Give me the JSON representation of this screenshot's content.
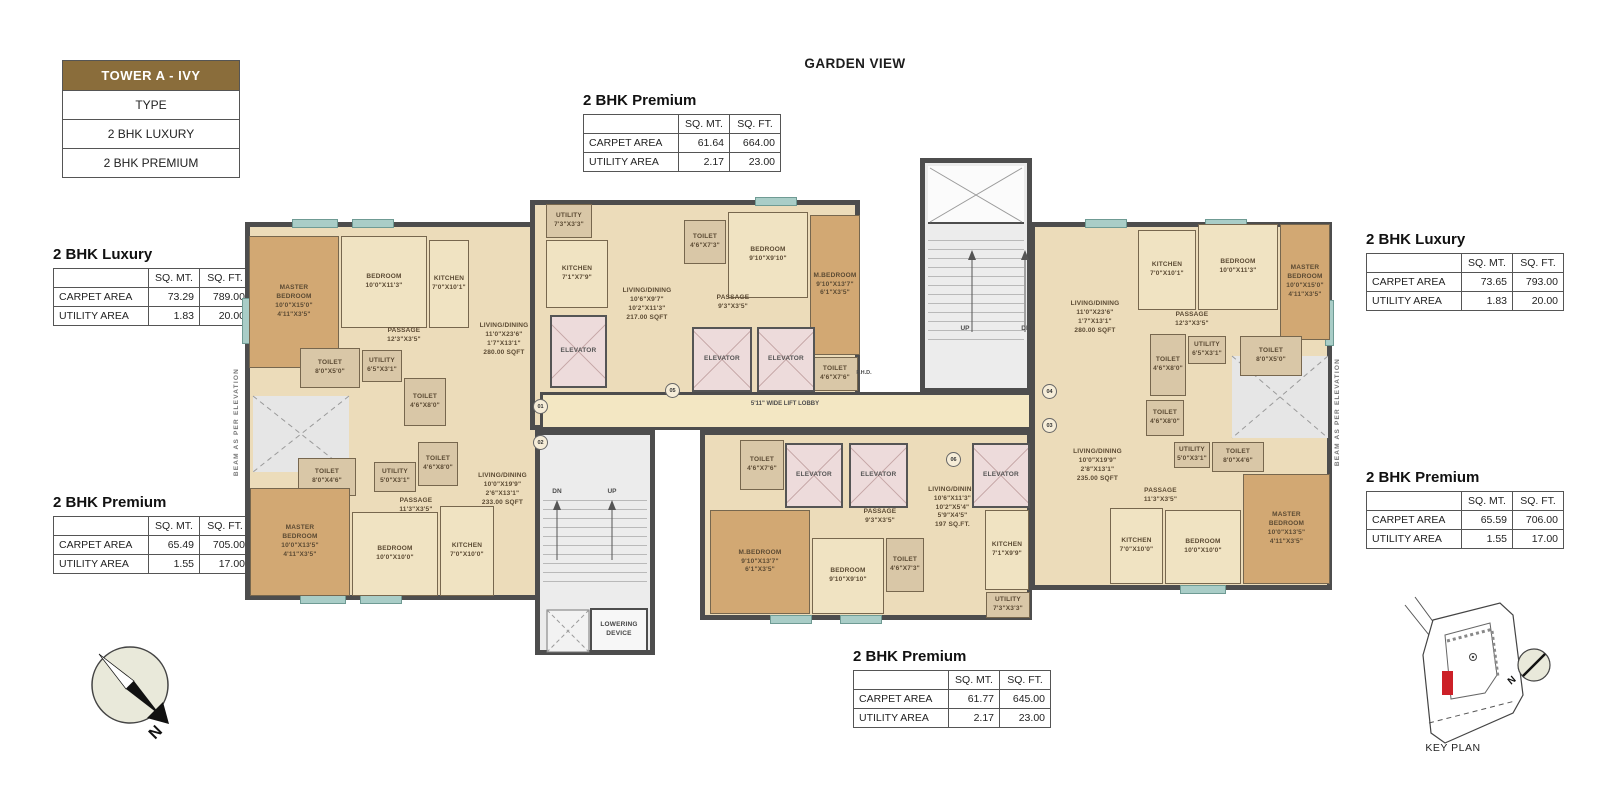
{
  "legend": {
    "title": "TOWER A - IVY",
    "rows": [
      "TYPE",
      "2 BHK LUXURY",
      "2 BHK PREMIUM"
    ]
  },
  "header": {
    "garden_view": "GARDEN VIEW"
  },
  "colors": {
    "legend_brown": "#8a6d3b",
    "wall": "#4d4d4d",
    "floor_beige": "#ecdcba",
    "wood": "#d2a873",
    "elevator_pink": "#eddbdb",
    "stair_gray": "#ececec",
    "keyplan_red": "#cc2027"
  },
  "area_tables": [
    {
      "id": "top-center",
      "title": "2 BHK Premium",
      "x": 583,
      "y": 92,
      "headers": [
        "SQ. MT.",
        "SQ. FT."
      ],
      "rows": [
        [
          "CARPET AREA",
          "61.64",
          "664.00"
        ],
        [
          "UTILITY AREA",
          "2.17",
          "23.00"
        ]
      ]
    },
    {
      "id": "left-luxury",
      "title": "2 BHK Luxury",
      "x": 53,
      "y": 246,
      "headers": [
        "SQ. MT.",
        "SQ. FT."
      ],
      "rows": [
        [
          "CARPET AREA",
          "73.29",
          "789.00"
        ],
        [
          "UTILITY AREA",
          "1.83",
          "20.00"
        ]
      ]
    },
    {
      "id": "left-premium",
      "title": "2 BHK Premium",
      "x": 53,
      "y": 494,
      "headers": [
        "SQ. MT.",
        "SQ. FT."
      ],
      "rows": [
        [
          "CARPET AREA",
          "65.49",
          "705.00"
        ],
        [
          "UTILITY AREA",
          "1.55",
          "17.00"
        ]
      ]
    },
    {
      "id": "right-luxury",
      "title": "2 BHK Luxury",
      "x": 1366,
      "y": 231,
      "headers": [
        "SQ. MT.",
        "SQ. FT."
      ],
      "rows": [
        [
          "CARPET AREA",
          "73.65",
          "793.00"
        ],
        [
          "UTILITY AREA",
          "1.83",
          "20.00"
        ]
      ]
    },
    {
      "id": "right-premium",
      "title": "2 BHK Premium",
      "x": 1366,
      "y": 469,
      "headers": [
        "SQ. MT.",
        "SQ. FT."
      ],
      "rows": [
        [
          "CARPET AREA",
          "65.59",
          "706.00"
        ],
        [
          "UTILITY AREA",
          "1.55",
          "17.00"
        ]
      ]
    },
    {
      "id": "bottom-center",
      "title": "2 BHK Premium",
      "x": 853,
      "y": 648,
      "headers": [
        "SQ. MT.",
        "SQ. FT."
      ],
      "rows": [
        [
          "CARPET AREA",
          "61.77",
          "645.00"
        ],
        [
          "UTILITY AREA",
          "2.17",
          "23.00"
        ]
      ]
    }
  ],
  "floorplan": {
    "rooms": [
      {
        "name": "master-bedroom-left",
        "lines": [
          "MASTER",
          "BEDROOM",
          "10'0\"X15'0\"",
          "4'11\"X3'5\""
        ],
        "x": 249,
        "y": 236,
        "w": 90,
        "h": 132,
        "fill": "wood"
      },
      {
        "name": "bedroom-left",
        "lines": [
          "BEDROOM",
          "10'0\"X11'3\""
        ],
        "x": 341,
        "y": 236,
        "w": 86,
        "h": 92,
        "fill": "beige"
      },
      {
        "name": "kitchen-left",
        "lines": [
          "KITCHEN",
          "7'0\"X10'1\""
        ],
        "x": 429,
        "y": 240,
        "w": 40,
        "h": 88,
        "fill": "beige"
      },
      {
        "name": "passage-left",
        "lines": [
          "PASSAGE",
          "12'3\"X3'5\""
        ],
        "x": 358,
        "y": 324,
        "w": 92,
        "h": 24,
        "fill": "none"
      },
      {
        "name": "utility-left",
        "lines": [
          "UTILITY",
          "6'5\"X3'1\""
        ],
        "x": 362,
        "y": 350,
        "w": 40,
        "h": 32,
        "fill": "tan"
      },
      {
        "name": "toilet-left-1",
        "lines": [
          "TOILET",
          "8'0\"X5'0\""
        ],
        "x": 300,
        "y": 348,
        "w": 60,
        "h": 40,
        "fill": "tan"
      },
      {
        "name": "toilet-left-2",
        "lines": [
          "TOILET",
          "4'6\"X8'0\""
        ],
        "x": 404,
        "y": 378,
        "w": 42,
        "h": 48,
        "fill": "tan"
      },
      {
        "name": "living-dining-left",
        "lines": [
          "LIVING/DINING",
          "11'0\"X23'6\"",
          "1'7\"X13'1\"",
          "280.00 SQFT"
        ],
        "x": 468,
        "y": 280,
        "w": 72,
        "h": 120,
        "fill": "none"
      },
      {
        "name": "utility-top-center",
        "lines": [
          "UTILITY",
          "7'3\"X3'3\""
        ],
        "x": 546,
        "y": 204,
        "w": 46,
        "h": 34,
        "fill": "tan"
      },
      {
        "name": "kitchen-top-center",
        "lines": [
          "KITCHEN",
          "7'1\"X7'9\""
        ],
        "x": 546,
        "y": 240,
        "w": 62,
        "h": 68,
        "fill": "beige"
      },
      {
        "name": "living-dining-top-center",
        "lines": [
          "LIVING/DINING",
          "10'6\"X9'7\"",
          "10'2\"X11'3\"",
          "217.00 SQFT"
        ],
        "x": 612,
        "y": 270,
        "w": 70,
        "h": 70,
        "fill": "none"
      },
      {
        "name": "toilet-top-center-1",
        "lines": [
          "TOILET",
          "4'6\"X7'3\""
        ],
        "x": 684,
        "y": 220,
        "w": 42,
        "h": 44,
        "fill": "tan"
      },
      {
        "name": "bedroom-top-center",
        "lines": [
          "BEDROOM",
          "9'10\"X9'10\""
        ],
        "x": 728,
        "y": 212,
        "w": 80,
        "h": 86,
        "fill": "beige"
      },
      {
        "name": "master-bedroom-top-center",
        "lines": [
          "M.BEDROOM",
          "9'10\"X13'7\"",
          "6'1\"X3'5\""
        ],
        "x": 810,
        "y": 215,
        "w": 50,
        "h": 140,
        "fill": "wood"
      },
      {
        "name": "passage-top-center",
        "lines": [
          "PASSAGE",
          "9'3\"X3'5\""
        ],
        "x": 694,
        "y": 293,
        "w": 78,
        "h": 20,
        "fill": "none"
      },
      {
        "name": "toilet-top-center-2",
        "lines": [
          "TOILET",
          "4'6\"X7'6\""
        ],
        "x": 812,
        "y": 357,
        "w": 46,
        "h": 34,
        "fill": "tan"
      },
      {
        "name": "living-dining-right",
        "lines": [
          "LIVING/DINING",
          "11'0\"X23'6\"",
          "1'7\"X13'1\"",
          "280.00 SQFT"
        ],
        "x": 1055,
        "y": 258,
        "w": 80,
        "h": 120,
        "fill": "none"
      },
      {
        "name": "kitchen-right",
        "lines": [
          "KITCHEN",
          "7'0\"X10'1\""
        ],
        "x": 1138,
        "y": 230,
        "w": 58,
        "h": 80,
        "fill": "beige"
      },
      {
        "name": "bedroom-right",
        "lines": [
          "BEDROOM",
          "10'0\"X11'3\""
        ],
        "x": 1198,
        "y": 224,
        "w": 80,
        "h": 86,
        "fill": "beige"
      },
      {
        "name": "master-bedroom-right",
        "lines": [
          "MASTER",
          "BEDROOM",
          "10'0\"X15'0\"",
          "4'11\"X3'5\""
        ],
        "x": 1280,
        "y": 224,
        "w": 50,
        "h": 116,
        "fill": "wood"
      },
      {
        "name": "passage-right",
        "lines": [
          "PASSAGE",
          "12'3\"X3'5\""
        ],
        "x": 1148,
        "y": 310,
        "w": 88,
        "h": 20,
        "fill": "none"
      },
      {
        "name": "toilet-right-1",
        "lines": [
          "TOILET",
          "4'6\"X8'0\""
        ],
        "x": 1150,
        "y": 334,
        "w": 36,
        "h": 62,
        "fill": "tan"
      },
      {
        "name": "utility-right",
        "lines": [
          "UTILITY",
          "6'5\"X3'1\""
        ],
        "x": 1188,
        "y": 336,
        "w": 38,
        "h": 28,
        "fill": "tan"
      },
      {
        "name": "toilet-right-2",
        "lines": [
          "TOILET",
          "8'0\"X5'0\""
        ],
        "x": 1240,
        "y": 336,
        "w": 62,
        "h": 40,
        "fill": "tan"
      },
      {
        "name": "living-dining-right-lower",
        "lines": [
          "LIVING/DINING",
          "10'0\"X19'9\"",
          "2'8\"X13'1\"",
          "235.00 SQFT"
        ],
        "x": 1055,
        "y": 435,
        "w": 85,
        "h": 62,
        "fill": "none"
      },
      {
        "name": "toilet-right-lower-1",
        "lines": [
          "TOILET",
          "4'6\"X8'0\""
        ],
        "x": 1146,
        "y": 400,
        "w": 38,
        "h": 36,
        "fill": "tan"
      },
      {
        "name": "utility-right-lower",
        "lines": [
          "UTILITY",
          "5'0\"X3'1\""
        ],
        "x": 1174,
        "y": 442,
        "w": 36,
        "h": 26,
        "fill": "tan"
      },
      {
        "name": "toilet-right-lower-2",
        "lines": [
          "TOILET",
          "8'0\"X4'6\""
        ],
        "x": 1212,
        "y": 442,
        "w": 52,
        "h": 30,
        "fill": "tan"
      },
      {
        "name": "passage-right-lower",
        "lines": [
          "PASSAGE",
          "11'3\"X3'5\""
        ],
        "x": 1118,
        "y": 487,
        "w": 85,
        "h": 18,
        "fill": "none"
      },
      {
        "name": "master-bedroom-right-lower",
        "lines": [
          "MASTER",
          "BEDROOM",
          "10'0\"X13'5\"",
          "4'11\"X3'5\""
        ],
        "x": 1243,
        "y": 474,
        "w": 87,
        "h": 110,
        "fill": "wood"
      },
      {
        "name": "bedroom-right-lower",
        "lines": [
          "BEDROOM",
          "10'0\"X10'0\""
        ],
        "x": 1165,
        "y": 510,
        "w": 76,
        "h": 74,
        "fill": "beige"
      },
      {
        "name": "kitchen-right-lower",
        "lines": [
          "KITCHEN",
          "7'0\"X10'0\""
        ],
        "x": 1110,
        "y": 508,
        "w": 53,
        "h": 76,
        "fill": "beige"
      },
      {
        "name": "toilet-left-lower-1",
        "lines": [
          "TOILET",
          "8'0\"X4'6\""
        ],
        "x": 298,
        "y": 458,
        "w": 58,
        "h": 38,
        "fill": "tan"
      },
      {
        "name": "utility-left-lower",
        "lines": [
          "UTILITY",
          "5'0\"X3'1\""
        ],
        "x": 374,
        "y": 462,
        "w": 42,
        "h": 30,
        "fill": "tan"
      },
      {
        "name": "toilet-left-lower-2",
        "lines": [
          "TOILET",
          "4'6\"X8'0\""
        ],
        "x": 418,
        "y": 442,
        "w": 40,
        "h": 44,
        "fill": "tan"
      },
      {
        "name": "passage-left-lower",
        "lines": [
          "PASSAGE",
          "11'3\"X3'5\""
        ],
        "x": 372,
        "y": 496,
        "w": 88,
        "h": 20,
        "fill": "none"
      },
      {
        "name": "master-bedroom-left-lower",
        "lines": [
          "MASTER",
          "BEDROOM",
          "10'0\"X13'5\"",
          "4'11\"X3'5\""
        ],
        "x": 250,
        "y": 488,
        "w": 100,
        "h": 108,
        "fill": "wood"
      },
      {
        "name": "bedroom-left-lower",
        "lines": [
          "BEDROOM",
          "10'0\"X10'0\""
        ],
        "x": 352,
        "y": 512,
        "w": 86,
        "h": 84,
        "fill": "beige"
      },
      {
        "name": "kitchen-left-lower",
        "lines": [
          "KITCHEN",
          "7'0\"X10'0\""
        ],
        "x": 440,
        "y": 506,
        "w": 54,
        "h": 90,
        "fill": "beige"
      },
      {
        "name": "living-dining-left-lower",
        "lines": [
          "LIVING/DINING",
          "10'0\"X19'9\"",
          "2'6\"X13'1\"",
          "233.00 SQFT"
        ],
        "x": 465,
        "y": 455,
        "w": 75,
        "h": 70,
        "fill": "none"
      },
      {
        "name": "toilet-bottom-center-1",
        "lines": [
          "TOILET",
          "4'6\"X7'6\""
        ],
        "x": 740,
        "y": 440,
        "w": 44,
        "h": 50,
        "fill": "tan"
      },
      {
        "name": "passage-bottom-center",
        "lines": [
          "PASSAGE",
          "9'3\"X3'5\""
        ],
        "x": 838,
        "y": 508,
        "w": 84,
        "h": 18,
        "fill": "none"
      },
      {
        "name": "living-dining-bottom-center",
        "lines": [
          "LIVING/DINING",
          "10'6\"X11'3\"",
          "10'2\"X5'4\"",
          "5'9\"X4'5\"",
          "197 SQ.FT."
        ],
        "x": 905,
        "y": 468,
        "w": 95,
        "h": 80,
        "fill": "none"
      },
      {
        "name": "master-bedroom-bottom-center",
        "lines": [
          "M.BEDROOM",
          "9'10\"X13'7\"",
          "6'1\"X3'5\""
        ],
        "x": 710,
        "y": 510,
        "w": 100,
        "h": 104,
        "fill": "wood"
      },
      {
        "name": "bedroom-bottom-center",
        "lines": [
          "BEDROOM",
          "9'10\"X9'10\""
        ],
        "x": 812,
        "y": 538,
        "w": 72,
        "h": 76,
        "fill": "beige"
      },
      {
        "name": "toilet-bottom-center-2",
        "lines": [
          "TOILET",
          "4'6\"X7'3\""
        ],
        "x": 886,
        "y": 538,
        "w": 38,
        "h": 54,
        "fill": "tan"
      },
      {
        "name": "kitchen-bottom-center",
        "lines": [
          "KITCHEN",
          "7'1\"X9'9\""
        ],
        "x": 985,
        "y": 510,
        "w": 44,
        "h": 80,
        "fill": "beige"
      },
      {
        "name": "utility-bottom-center",
        "lines": [
          "UTILITY",
          "7'3\"X3'3\""
        ],
        "x": 986,
        "y": 592,
        "w": 44,
        "h": 26,
        "fill": "tan"
      },
      {
        "name": "elevator-1",
        "lines": [
          "ELEVATOR"
        ],
        "x": 550,
        "y": 315,
        "w": 57,
        "h": 73,
        "fill": "pink"
      },
      {
        "name": "elevator-2",
        "lines": [
          "ELEVATOR"
        ],
        "x": 692,
        "y": 327,
        "w": 60,
        "h": 65,
        "fill": "pink"
      },
      {
        "name": "elevator-3",
        "lines": [
          "ELEVATOR"
        ],
        "x": 757,
        "y": 327,
        "w": 58,
        "h": 65,
        "fill": "pink"
      },
      {
        "name": "elevator-4",
        "lines": [
          "ELEVATOR"
        ],
        "x": 785,
        "y": 443,
        "w": 58,
        "h": 65,
        "fill": "pink"
      },
      {
        "name": "elevator-5",
        "lines": [
          "ELEVATOR"
        ],
        "x": 849,
        "y": 443,
        "w": 59,
        "h": 65,
        "fill": "pink"
      },
      {
        "name": "elevator-6",
        "lines": [
          "ELEVATOR"
        ],
        "x": 972,
        "y": 443,
        "w": 58,
        "h": 65,
        "fill": "pink"
      },
      {
        "name": "lowering-device",
        "lines": [
          "LOWERING",
          "DEVICE"
        ],
        "x": 590,
        "y": 608,
        "w": 58,
        "h": 44,
        "fill": "white"
      }
    ],
    "annotations": [
      {
        "text": "5'11\" WIDE LIFT LOBBY",
        "x": 700,
        "y": 401,
        "w": 170,
        "size": 6
      },
      {
        "text": "F.H.D.",
        "x": 848,
        "y": 370,
        "w": 32,
        "size": 5.5
      },
      {
        "text": "UP",
        "x": 953,
        "y": 325,
        "w": 24,
        "size": 6.5
      },
      {
        "text": "DN",
        "x": 1014,
        "y": 325,
        "w": 24,
        "size": 6.5
      },
      {
        "text": "DN",
        "x": 545,
        "y": 488,
        "w": 24,
        "size": 6.5
      },
      {
        "text": "UP",
        "x": 600,
        "y": 488,
        "w": 24,
        "size": 6.5
      }
    ],
    "vertical_texts": [
      {
        "text": "BEAM AS PER ELEVATION",
        "x": 233,
        "y": 368
      },
      {
        "text": "BEAM AS PER ELEVATION",
        "x": 1334,
        "y": 358
      }
    ],
    "badges": [
      {
        "text": "01",
        "x": 533,
        "y": 399
      },
      {
        "text": "02",
        "x": 533,
        "y": 435
      },
      {
        "text": "05",
        "x": 665,
        "y": 383
      },
      {
        "text": "06",
        "x": 946,
        "y": 452
      },
      {
        "text": "04",
        "x": 1042,
        "y": 384
      },
      {
        "text": "03",
        "x": 1042,
        "y": 418
      }
    ]
  },
  "compass": {
    "north_label": "N"
  },
  "key_plan": {
    "label": "KEY PLAN",
    "north_label": "N"
  }
}
